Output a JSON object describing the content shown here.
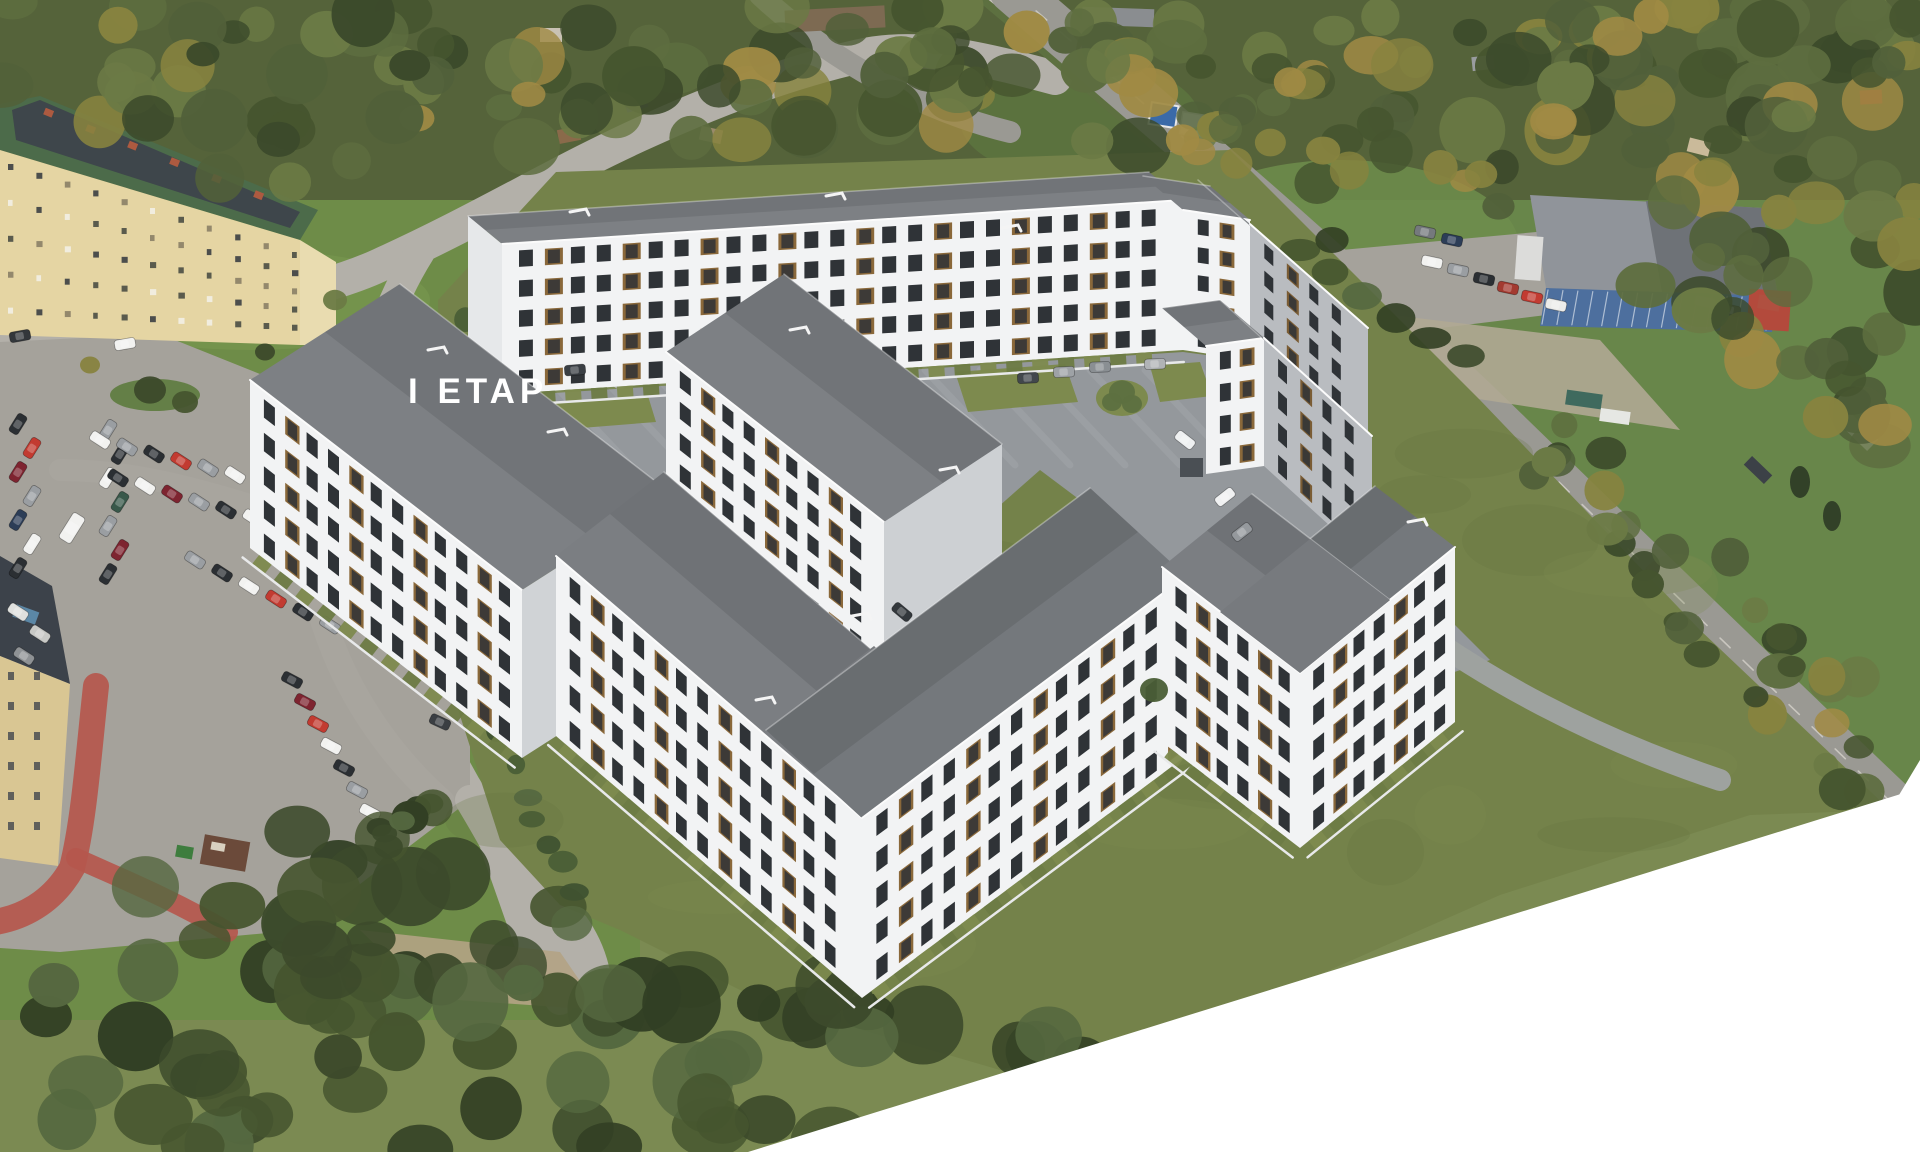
{
  "label": {
    "phase": "I ETAP"
  },
  "palette": {
    "base_left_grass": "#6e8c48",
    "base_right_grass": "#68864a",
    "render_grass": "#74824a",
    "render_grass_dark": "#65733f",
    "tree_dark": "#3c4a2b",
    "tree_mid": "#51603a",
    "tree_light": "#6b7a45",
    "tree_autumn": "#a08a44",
    "roof_gray": "#7d8084",
    "roof_gray_dark": "#6f7377",
    "wall_white": "#f2f3f4",
    "wall_shadow": "#b9bcc0",
    "window_dark": "#2f3337",
    "wood_accent": "#8a683a",
    "wood_shadow": "#7a5c34",
    "road": "#b3b0a9",
    "asphalt": "#a5a29b",
    "paving": "#94989c",
    "sidewalk": "#c6c3ba",
    "red_path": "#b5574d",
    "old_wall": "#e5d5a3",
    "old_roof_green": "#4c6b4a",
    "old_roof_panel": "#3d434b",
    "chimney_red": "#ad5a40",
    "glass_blue": "#4d6f9e",
    "accent_red": "#b34a3c",
    "hedge": "#46552f",
    "lawn": "#7d8a4e",
    "white_cut": "#ffffff"
  }
}
